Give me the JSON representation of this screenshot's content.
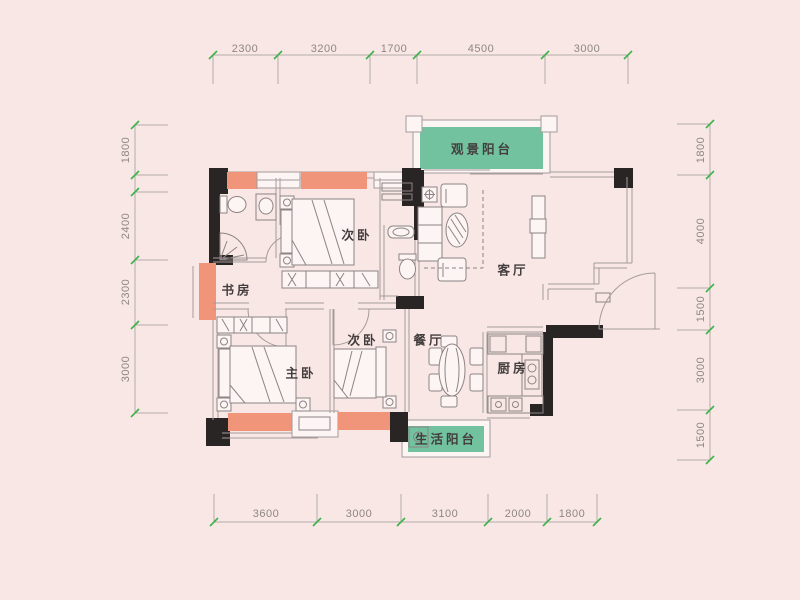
{
  "rooms": {
    "viewing_balcony": "观景阳台",
    "living_room": "客厅",
    "bedroom_top": "次卧",
    "study": "书房",
    "master_bedroom": "主卧",
    "bedroom_mid": "次卧",
    "dining_room": "餐厅",
    "kitchen": "厨房",
    "utility_balcony": "生活阳台"
  },
  "dimensions": {
    "top": [
      "2300",
      "3200",
      "1700",
      "4500",
      "3000"
    ],
    "left": [
      "1800",
      "2400",
      "2300",
      "3000"
    ],
    "right": [
      "1800",
      "4000",
      "1500",
      "3000",
      "1500"
    ],
    "bottom": [
      "3600",
      "3000",
      "3100",
      "2000",
      "1800"
    ]
  },
  "colors": {
    "background": "#f8e7e5",
    "balcony_green": "#72c2a0",
    "wall_salmon": "#f09579",
    "wall_black": "#2a2525",
    "wall_line": "#a59c9b",
    "dimension_line": "#b5acab",
    "tick_green": "#3cb24a",
    "label_text": "#433d3d",
    "dimension_text": "#8e8685",
    "fixture_fill": "#fcf5f4"
  }
}
